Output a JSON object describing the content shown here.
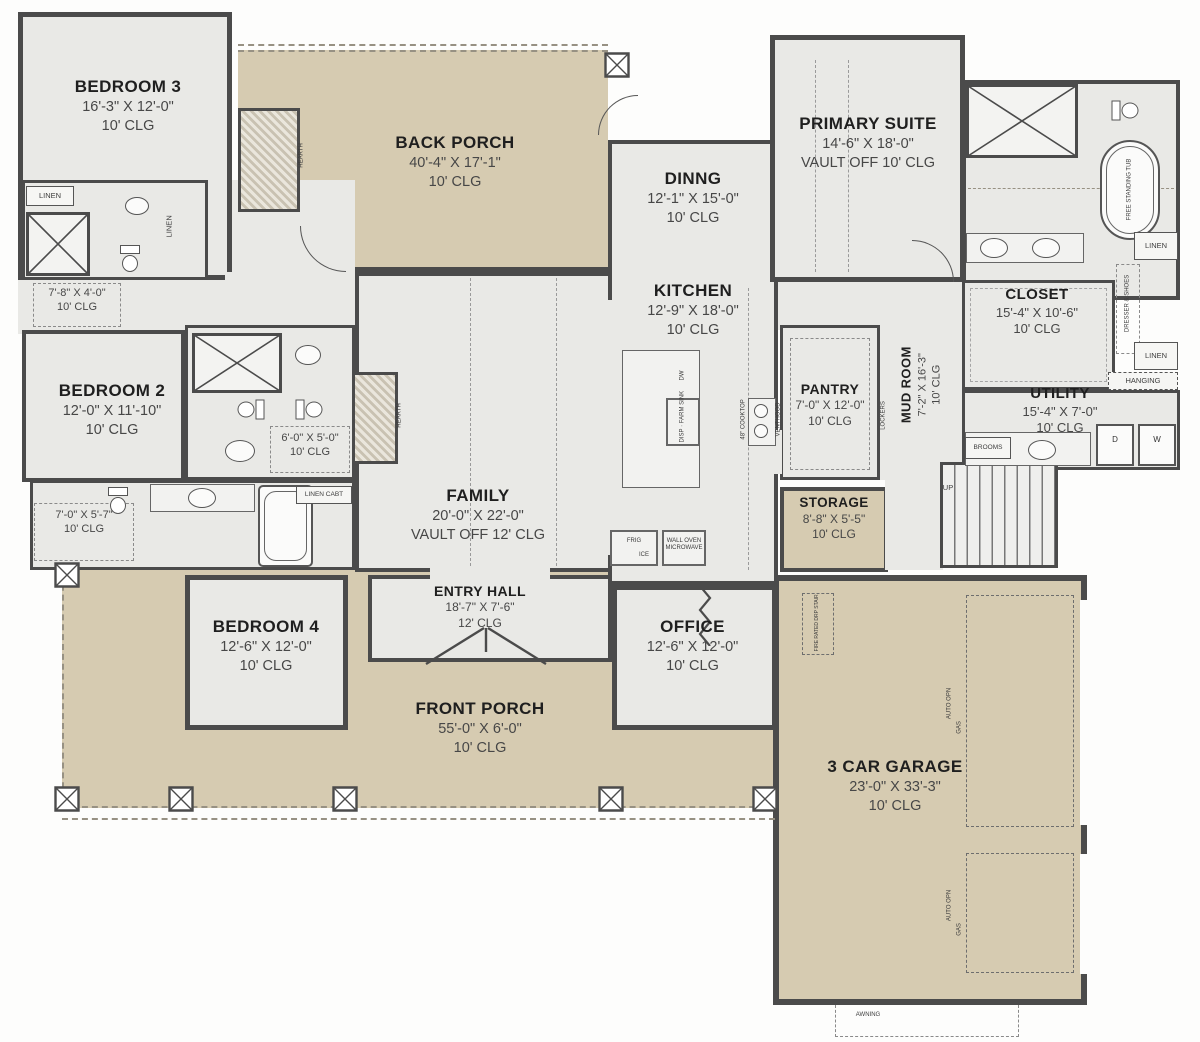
{
  "colors": {
    "porch_fill": "#d6cbb1",
    "floor_fill": "#e9e9e6",
    "wall": "#4b4b4b",
    "text": "#1f1f1f"
  },
  "rooms": {
    "bedroom3": {
      "name": "BEDROOM 3",
      "dims": "16'-3\" X 12'-0\"",
      "clg": "10' CLG"
    },
    "back_porch": {
      "name": "BACK PORCH",
      "dims": "40'-4\" X 17'-1\"",
      "clg": "10' CLG"
    },
    "primary_suite": {
      "name": "PRIMARY SUITE",
      "dims": "14'-6\" X 18'-0\"",
      "clg": "VAULT OFF 10' CLG"
    },
    "dining": {
      "name": "DINNG",
      "dims": "12'-1\" X 15'-0\"",
      "clg": "10' CLG"
    },
    "kitchen": {
      "name": "KITCHEN",
      "dims": "12'-9\" X 18'-0\"",
      "clg": "10' CLG"
    },
    "primary_closet": {
      "name": "CLOSET",
      "dims": "15'-4\" X 10'-6\"",
      "clg": "10' CLG"
    },
    "utility": {
      "name": "UTILITY",
      "dims": "15'-4\" X 7'-0\"",
      "clg": "10' CLG"
    },
    "pantry": {
      "name": "PANTRY",
      "dims": "7'-0\" X 12'-0\"",
      "clg": "10' CLG"
    },
    "mud_room": {
      "name": "MUD ROOM",
      "dims": "7'-2\" X 16'-3\"",
      "clg": "10' CLG"
    },
    "storage": {
      "name": "STORAGE",
      "dims": "8'-8\" X 5'-5\"",
      "clg": "10' CLG"
    },
    "bedroom2": {
      "name": "BEDROOM 2",
      "dims": "12'-0\" X 11'-10\"",
      "clg": "10' CLG"
    },
    "family": {
      "name": "FAMILY",
      "dims": "20'-0\" X 22'-0\"",
      "clg": "VAULT OFF 12' CLG"
    },
    "bedroom4": {
      "name": "BEDROOM 4",
      "dims": "12'-6\" X 12'-0\"",
      "clg": "10' CLG"
    },
    "entry_hall": {
      "name": "ENTRY HALL",
      "dims": "18'-7\" X 7'-6\"",
      "clg": "12' CLG"
    },
    "office": {
      "name": "OFFICE",
      "dims": "12'-6\" X 12'-0\"",
      "clg": "10' CLG"
    },
    "front_porch": {
      "name": "FRONT PORCH",
      "dims": "55'-0\" X 6'-0\"",
      "clg": "10' CLG"
    },
    "garage": {
      "name": "3 CAR GARAGE",
      "dims": "23'-0\" X 33'-3\"",
      "clg": "10' CLG"
    }
  },
  "closets": {
    "bed3_closet": {
      "dims": "7'-8\" X 4'-0\"",
      "clg": "10' CLG"
    },
    "jj_closet": {
      "dims": "6'-0\" X 5'-0\"",
      "clg": "10' CLG"
    },
    "bed4_closet": {
      "dims": "7'-0\" X 5'-7\"",
      "clg": "10' CLG"
    }
  },
  "labels": {
    "linen": "LINEN",
    "hanging": "HANGING",
    "dresser_shoes": "DRESSER & SHOES",
    "linen_cabt": "LINEN CABT",
    "lockers": "LOCKERS",
    "brooms": "BROOMS",
    "hearth": "HEARTH",
    "frig": "FRIG",
    "ice": "ICE",
    "wall_oven_line1": "WALL OVEN",
    "wall_oven_line2": "MICROWAVE",
    "dw": "DW",
    "disp": "DISP",
    "farm_sink": "FARM SINK",
    "cooktop": "48\" COOKTOP",
    "venthood": "VENTHOOD",
    "free_standing_tub": "FREE STANDING TUB",
    "up": "UP",
    "auto_opn": "AUTO OPN",
    "gas": "GAS",
    "fire_rated_stair": "FIRE RATED DRP STAIR",
    "awning": "AWNING",
    "dryer": "D",
    "washer": "W"
  }
}
